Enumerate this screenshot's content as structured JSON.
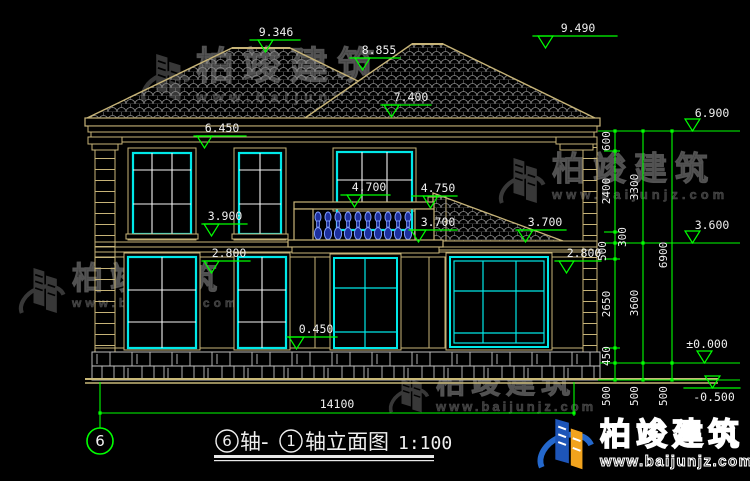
{
  "brand": {
    "name": "柏竣建筑",
    "url": "www.baijunjz.com"
  },
  "title": {
    "axis_start": "6",
    "sep": "轴-",
    "axis_end": "1",
    "name": "轴立面图",
    "scale": "1:100"
  },
  "axis_bubble": "6",
  "total_width": "14100",
  "levels": {
    "roof_left": "9.346",
    "roof_mid": "8.855",
    "roof_right": "9.490",
    "eave_upper": "7.400",
    "eave_left": "6.450",
    "eave_right": "6.900",
    "balcony": "4.700",
    "porch_top": "4.750",
    "sill2": "3.900",
    "porch_eave_l": "3.700",
    "porch_eave_r": "3.700",
    "level_3600": "3.600",
    "floor1_l": "2.800",
    "floor1_r": "2.800",
    "sill1": "0.450",
    "zero": "±0.000",
    "minus_half": "-0.500"
  },
  "chains": {
    "inner": [
      "600",
      "2400",
      "300",
      "500",
      "2650",
      "450"
    ],
    "middle": [
      "3300",
      "3600"
    ],
    "outer": [
      "6900"
    ],
    "below": [
      "500",
      "500",
      "500"
    ]
  },
  "colors": {
    "background": "#000000",
    "dimension_green": "#00ff00",
    "dim_text_white": "#f0f0f0",
    "wall_tan": "#c7b478",
    "window_cyan": "#00e8e8",
    "mullion_white": "#f5f5f5",
    "baluster_blue": "#7f9cff",
    "stone_gray": "#c4c4c4",
    "hatch_gray": "#8d8d8d",
    "watermark_gray": "#3d3d3d",
    "logo_blue": "#1d55b8",
    "logo_orange": "#f2a31d"
  }
}
